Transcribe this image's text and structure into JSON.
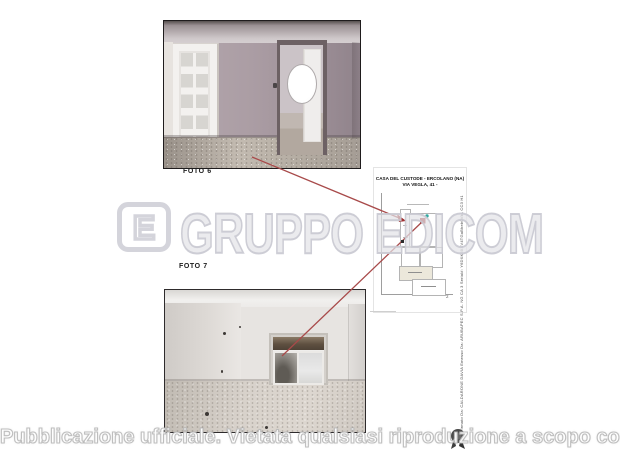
{
  "photos": {
    "foto6_label": "FOTO 6",
    "foto7_label": "FOTO 7"
  },
  "plan": {
    "title_line1": "CASA DEL CUSTODE - ERCOLANO (NA)",
    "title_line2": "VIA VEGLA, 41 -",
    "corner_mark": "2"
  },
  "watermark": {
    "logo_letter": "E",
    "text": "GRUPPO EDICOM"
  },
  "signature": {
    "text": "Firmato Da: CALDARONE DAVIA Emesso Da: ARUBAPEC S.P.A. NG CA 3 Serial#: Y6DXK6XXV4TGaBheb0VkL CC3 H1"
  },
  "banner": {
    "text": "Pubblicazione ufficiale. Vietata qualsiasi riproduzione a scopo commerciale"
  },
  "colors": {
    "red_line": "#a84a4a",
    "marker_red": "#a03030",
    "marker_teal": "#2fa8a0",
    "watermark_gray": "#cdcdd5"
  }
}
